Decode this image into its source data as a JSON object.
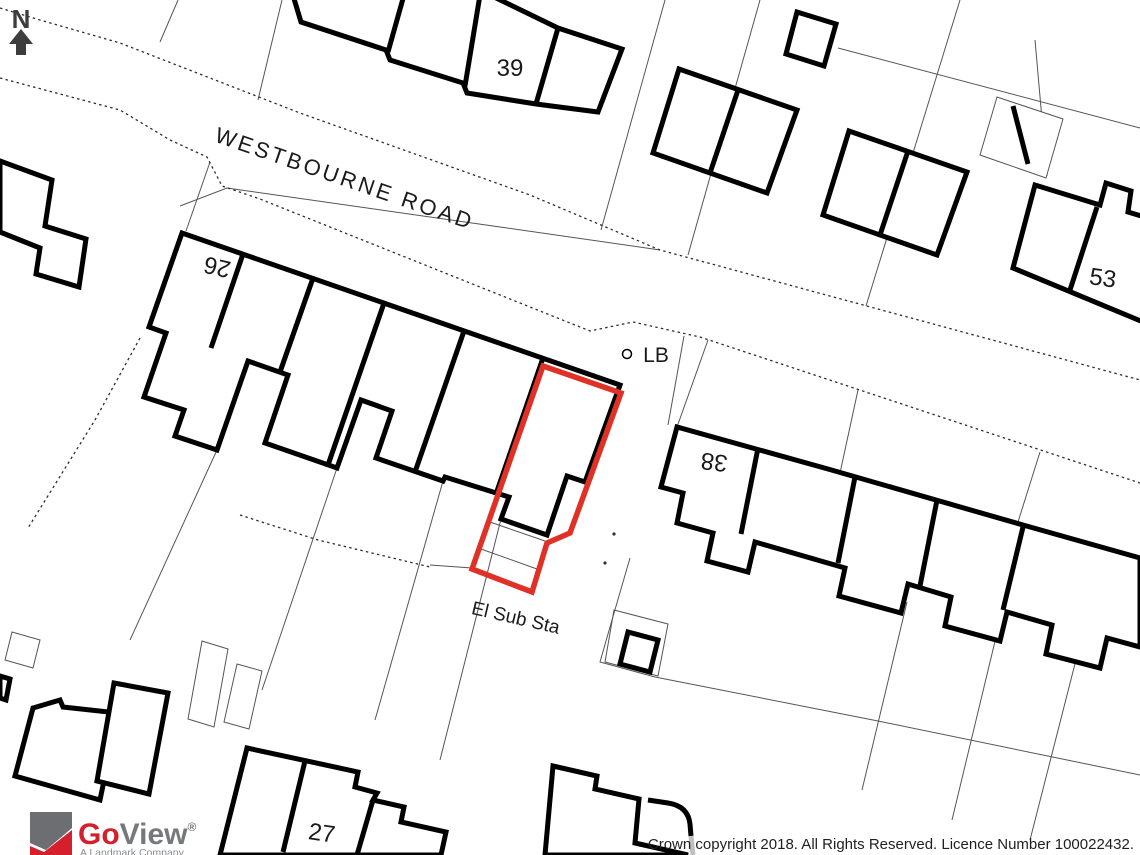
{
  "map": {
    "road_label": "WESTBOURNE ROAD",
    "north_label": "N",
    "labels": {
      "plot39": "39",
      "plot53": "53",
      "plot26": "26",
      "plot38": "38",
      "plot27": "27",
      "lb": "LB",
      "el_sub_sta": "El Sub Sta"
    },
    "highlight_color": "#e03127",
    "building_color": "#000000",
    "parcel_line_color": "#555555"
  },
  "branding": {
    "logo_go": "Go",
    "logo_view": "View",
    "logo_reg": "®",
    "tagline": "A Landmark Company",
    "logo_red": "#d4202c",
    "logo_gray": "#77787b"
  },
  "footer": {
    "copyright": "Crown copyright 2018. All Rights Reserved. Licence Number 100022432."
  }
}
